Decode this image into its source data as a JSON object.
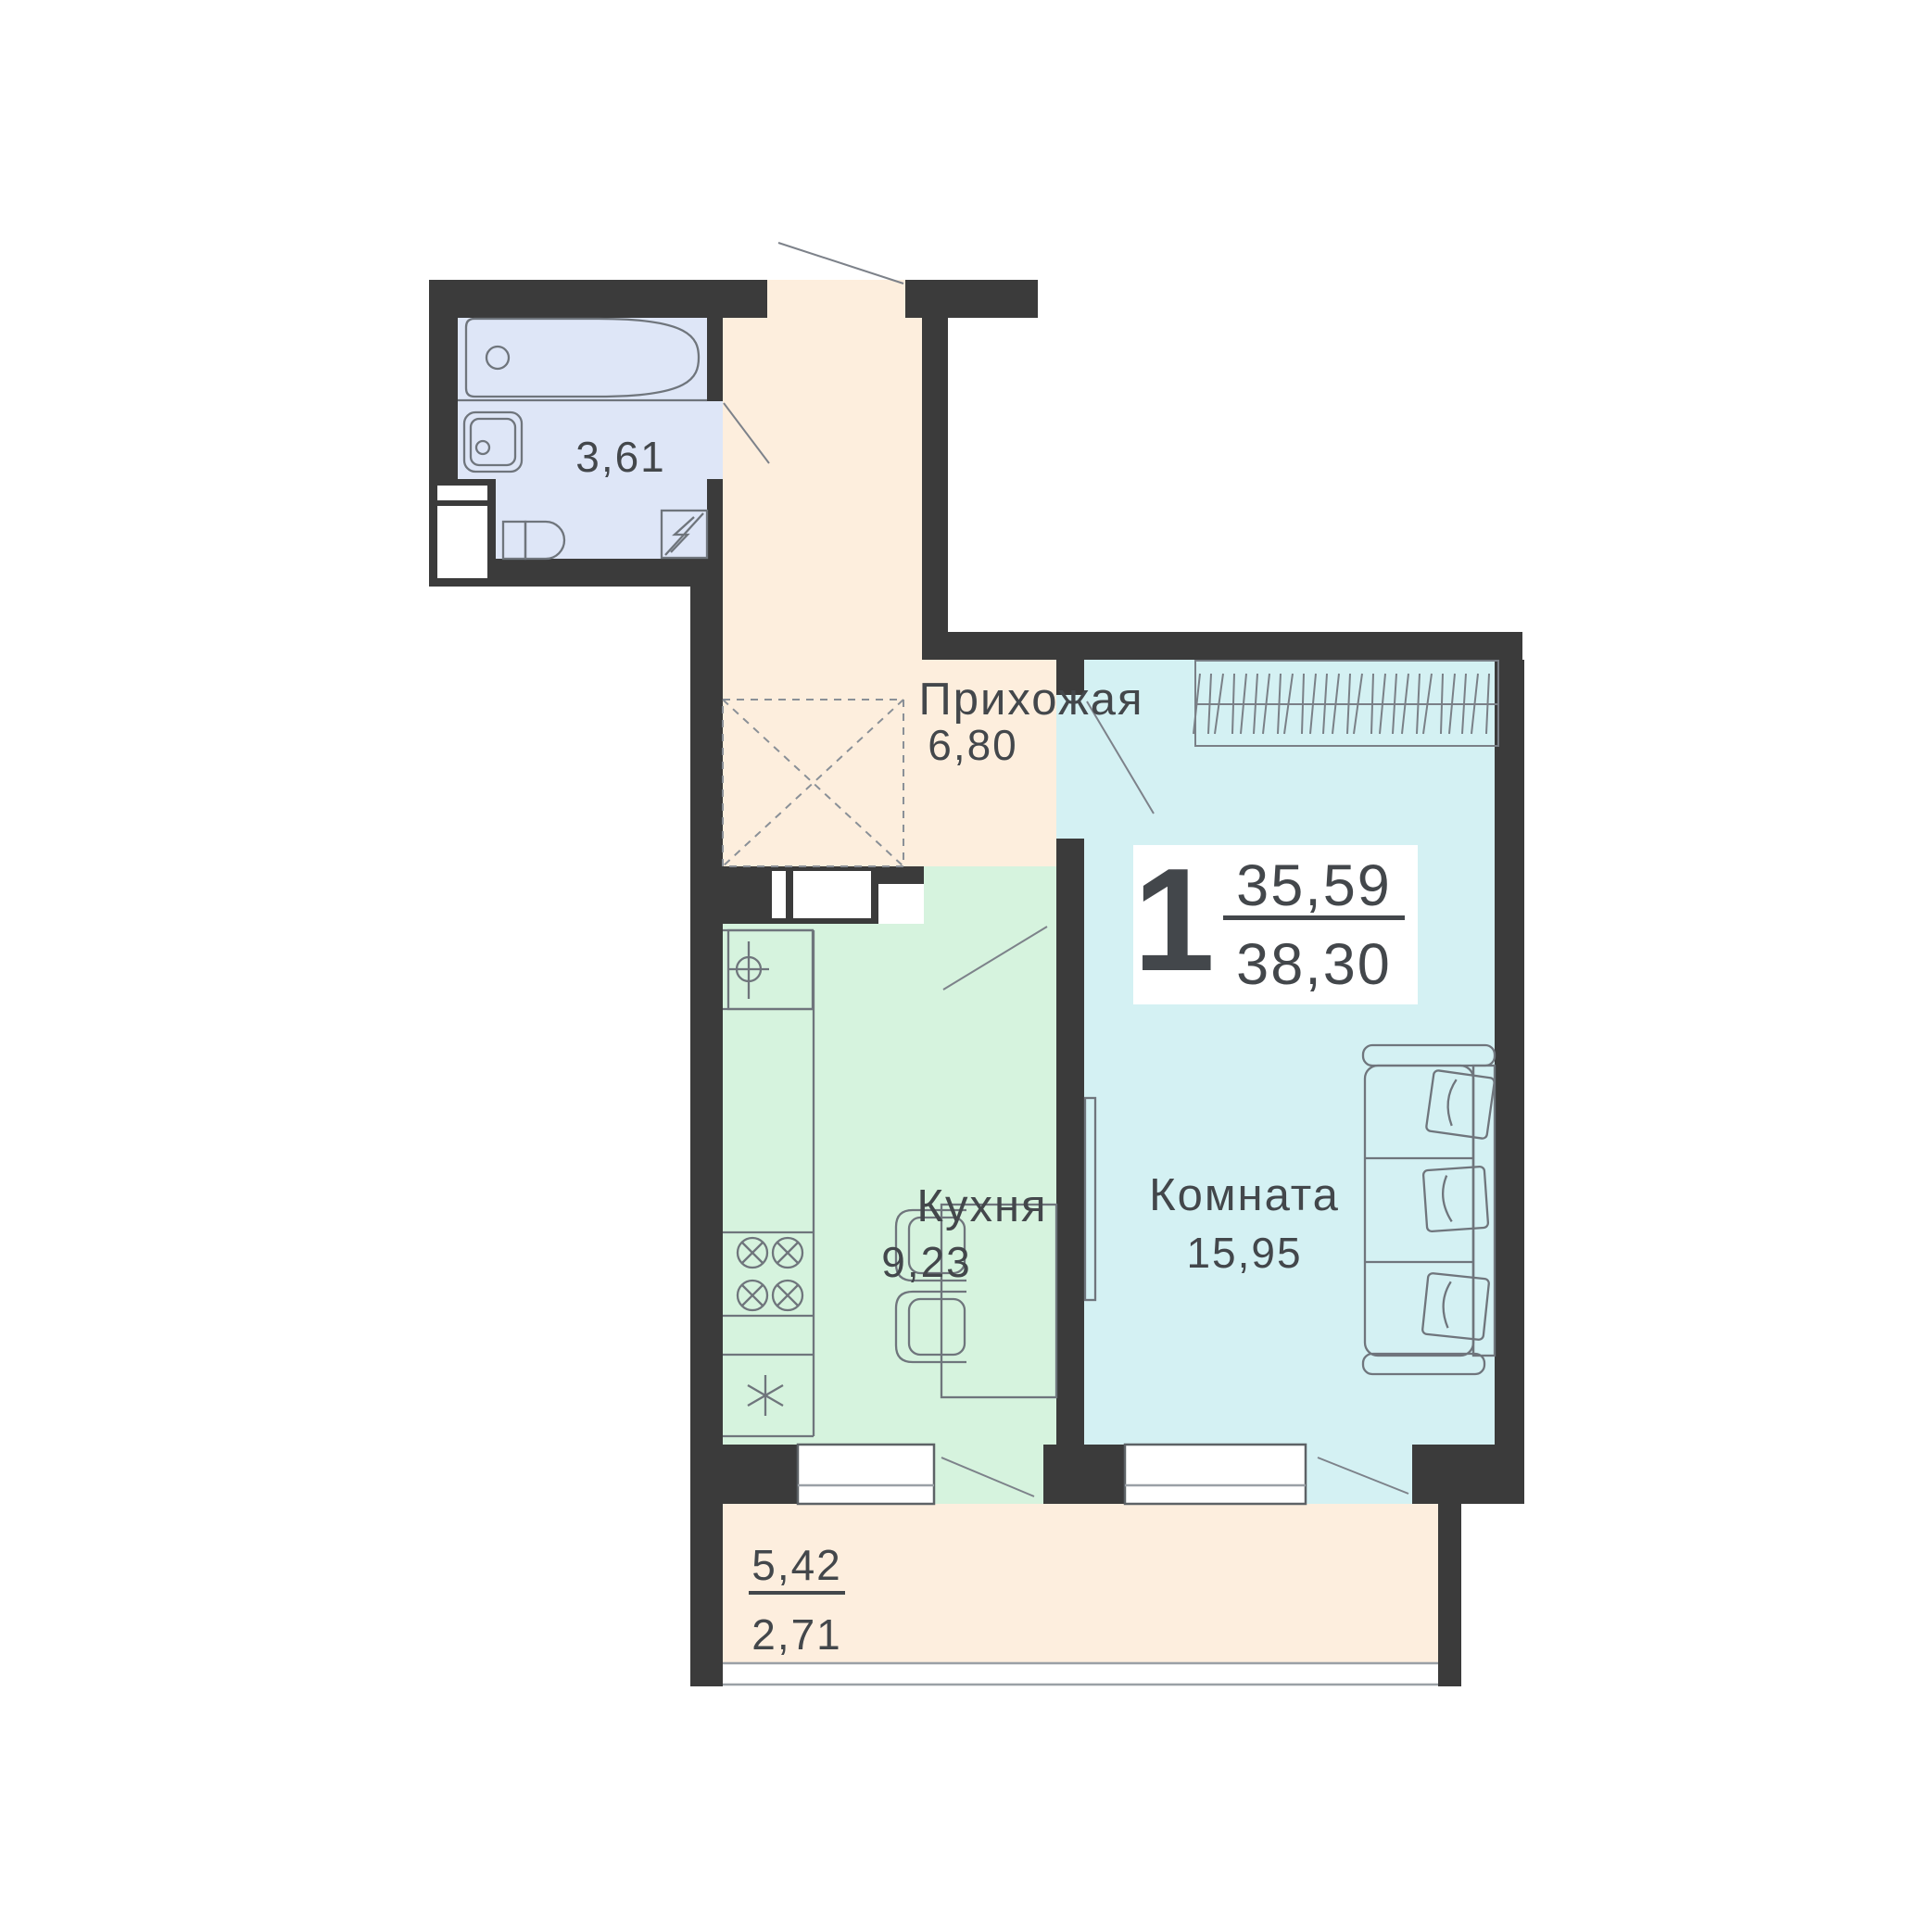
{
  "plan": {
    "title": "floor-plan-1-room-apartment",
    "badge": {
      "rooms_count": "1",
      "area_living": "35,59",
      "area_total": "38,30"
    },
    "rooms": {
      "bathroom": {
        "area": "3,61"
      },
      "hallway": {
        "label": "Прихожая",
        "area": "6,80"
      },
      "kitchen": {
        "label": "Кухня",
        "area": "9,23"
      },
      "living_room": {
        "label": "Комната",
        "area": "15,95"
      },
      "balcony": {
        "area_full": "5,42",
        "area_counted": "2,71"
      }
    },
    "colors": {
      "wall": "#3b3b3b",
      "bathroom": "#dee6f7",
      "hallway": "#fdeedd",
      "kitchen": "#d6f3de",
      "living_room": "#d4f1f3",
      "balcony": "#fdeede",
      "badge_bg": "#ffffff",
      "text": "#43474b"
    }
  }
}
